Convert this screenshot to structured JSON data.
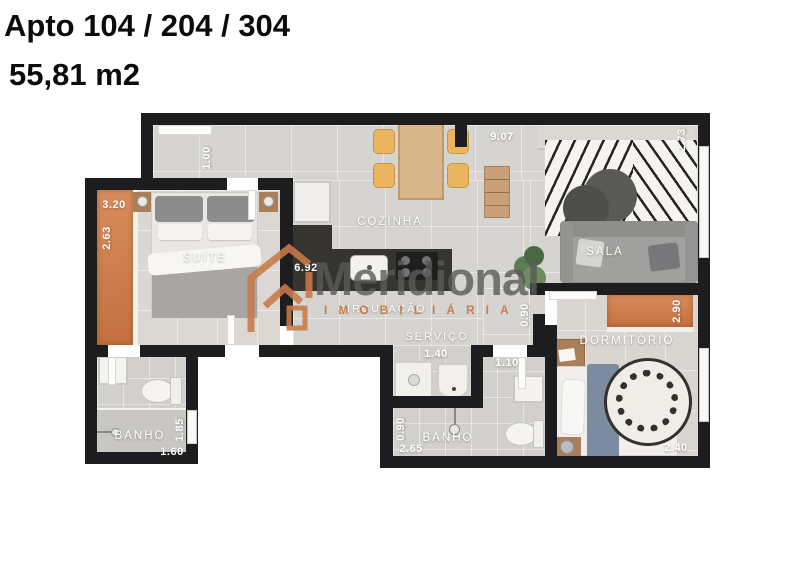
{
  "title": {
    "line1": "Apto 104 / 204 / 304",
    "line2": "55,81 m2"
  },
  "watermark": {
    "brand": "Meridional",
    "tagline": "IMOBILIÁRIA"
  },
  "rooms": {
    "suite": "SUÍTE",
    "kitchen": "COZINHA",
    "living": "SALA",
    "hall": "CIRCULAÇÃO",
    "laundry": "SERVIÇO",
    "bath_suite": "BANHO",
    "bath_social": "BANHO",
    "bedroom": "DORMITÓRIO"
  },
  "dimensions": {
    "entry_width": "1.00",
    "top_width": "9.07",
    "living_depth": "2.73",
    "suite_width": "3.20",
    "suite_balcony": "2.63",
    "kitchen_run": "6.92",
    "hall_width": "0.90",
    "bedroom_balcony": "2.90",
    "laundry_width": "1.40",
    "laundry_side": "1.10",
    "bath_social_width": "0.90",
    "bath_social_length": "2.65",
    "bath_suite_length": "1.85",
    "bath_suite_width": "1.60",
    "bedroom_width": "2.40"
  },
  "colors": {
    "accent_orange": "#C97C4A",
    "wall": "#1D1D1F",
    "floor": "#D6D4D1"
  }
}
